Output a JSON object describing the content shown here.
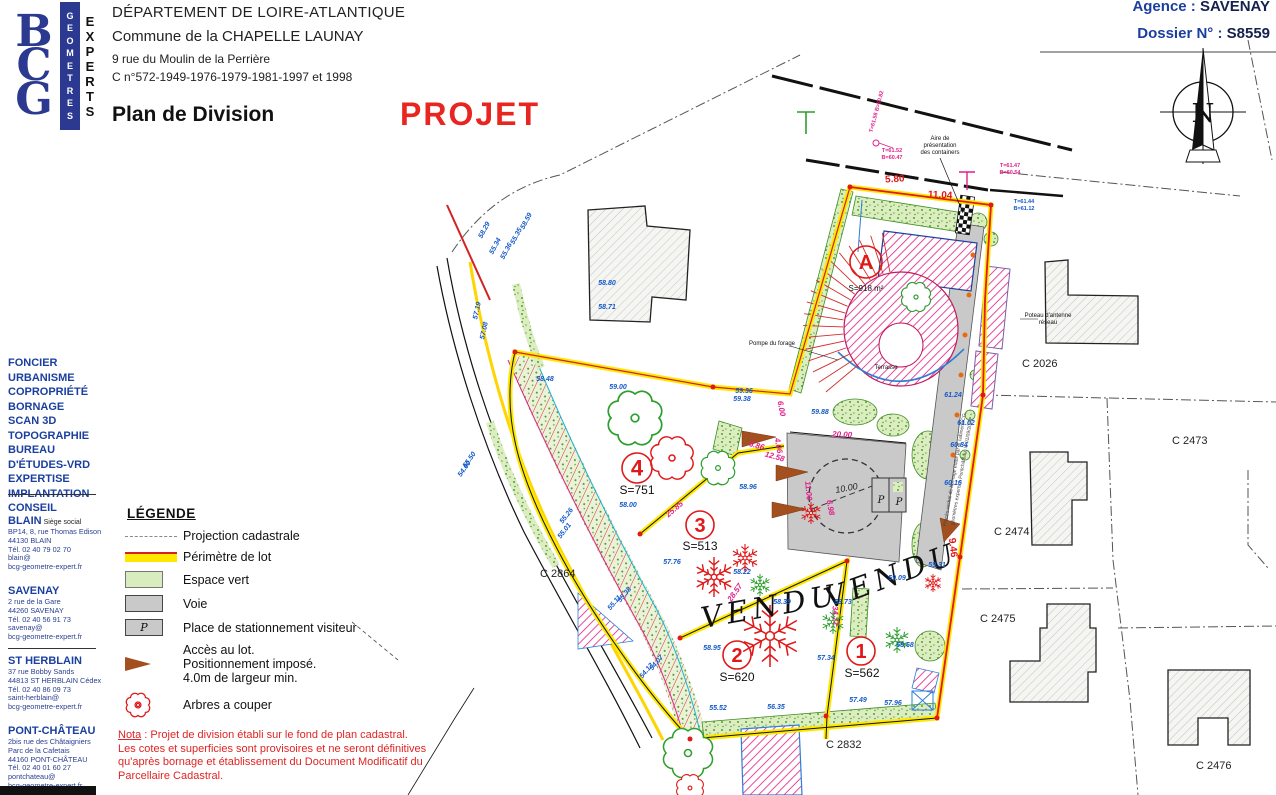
{
  "header": {
    "line1": "DÉPARTEMENT DE LOIRE-ATLANTIQUE",
    "line2": "Commune de la CHAPELLE LAUNAY",
    "line3": "9 rue du Moulin de la Perrière",
    "line4": "C n°572-1949-1976-1979-1981-1997 et 1998",
    "title": "Plan de Division",
    "stamp": "PROJET",
    "agency_label": "Agence",
    "agency_value": "SAVENAY",
    "dossier_label": "Dossier N°",
    "dossier_value": "S8559"
  },
  "logo": {
    "letters": [
      "B",
      "C",
      "G"
    ],
    "col1": "GEOMETRES",
    "col2": "EXPERTS"
  },
  "sidebar": {
    "services": [
      "FONCIER",
      "URBANISME",
      "COPROPRIÉTÉ",
      "BORNAGE",
      "SCAN 3D",
      "TOPOGRAPHIE",
      "BUREAU",
      "D'ÉTUDES-VRD",
      "EXPERTISE",
      "IMPLANTATION",
      "CONSEIL"
    ],
    "offices": [
      {
        "name": "BLAIN",
        "sub": "Siège social",
        "lines": [
          "BP14, 8, rue Thomas Edison",
          "44130 BLAIN",
          "Tél. 02 40 79 02 70",
          "blain@",
          "bcg-geometre-expert.fr"
        ]
      },
      {
        "name": "SAVENAY",
        "sub": "",
        "lines": [
          "2 rue de la Gare",
          "44260 SAVENAY",
          "Tél. 02 40 56 91 73",
          "savenay@",
          "bcg-geometre-expert.fr"
        ]
      },
      {
        "name": "ST HERBLAIN",
        "sub": "",
        "lines": [
          "37 rue Bobby Sands",
          "44813 ST HERBLAIN Cédex",
          "Tél. 02 40 86 09 73",
          "saint-herblain@",
          "bcg-geometre-expert.fr"
        ]
      },
      {
        "name": "PONT-CHÂTEAU",
        "sub": "",
        "lines": [
          "2bis rue des Châtaigniers",
          "Parc de la Cafetais",
          "44160 PONT-CHÂTEAU",
          "Tél. 02 40 01 60 27",
          "pontchateau@",
          "bcg-geometre-expert.fr"
        ]
      }
    ]
  },
  "legend": {
    "title": "LÉGENDE",
    "items": [
      {
        "sw": "cadastral",
        "lines": [
          "Projection cadastrale"
        ]
      },
      {
        "sw": "perimetre",
        "lines": [
          "Périmètre de lot"
        ]
      },
      {
        "sw": "vert",
        "lines": [
          "Espace vert"
        ]
      },
      {
        "sw": "voie",
        "lines": [
          "Voie"
        ]
      },
      {
        "sw": "parking",
        "p": "P",
        "lines": [
          "Place de stationnement visiteur"
        ]
      },
      {
        "sw": "acces",
        "lines": [
          "Accès au lot.",
          "Positionnement imposé.",
          "4.0m de largeur min."
        ]
      },
      {
        "sw": "arbre",
        "lines": [
          "Arbres a couper"
        ]
      }
    ]
  },
  "nota": {
    "label": "Nota",
    "line1rest": " : Projet de division établi sur le fond de plan cadastral.",
    "lines": [
      "Les cotes et superficies sont provisoires et ne seront définitives",
      "qu'après bornage et établissement du Document Modificatif du",
      "Parcellaire Cadastral."
    ]
  },
  "map": {
    "lots": [
      {
        "id": "A",
        "cx": 866,
        "cy": 262,
        "r": 16,
        "ns": 20,
        "area": "S=918 m²",
        "ax": 866,
        "ay": 291,
        "as": 8
      },
      {
        "id": "4",
        "cx": 637,
        "cy": 468,
        "r": 15,
        "ns": 22,
        "area": "S=751",
        "ax": 637,
        "ay": 494,
        "as": 12
      },
      {
        "id": "3",
        "cx": 700,
        "cy": 525,
        "r": 14,
        "ns": 20,
        "area": "S=513",
        "ax": 700,
        "ay": 550,
        "as": 12
      },
      {
        "id": "2",
        "cx": 737,
        "cy": 655,
        "r": 14,
        "ns": 20,
        "area": "S=620",
        "ax": 737,
        "ay": 681,
        "as": 12
      },
      {
        "id": "1",
        "cx": 861,
        "cy": 651,
        "r": 14,
        "ns": 20,
        "area": "S=562",
        "ax": 862,
        "ay": 677,
        "as": 12
      }
    ],
    "labels": [
      {
        "t": "C 2026",
        "x": 1022,
        "y": 367,
        "c": "parcel",
        "a": "start"
      },
      {
        "t": "C 2473",
        "x": 1172,
        "y": 444,
        "c": "parcel",
        "a": "start"
      },
      {
        "t": "C 2474",
        "x": 994,
        "y": 535,
        "c": "parcel",
        "a": "start"
      },
      {
        "t": "C 2475",
        "x": 980,
        "y": 622,
        "c": "parcel",
        "a": "start"
      },
      {
        "t": "C 2832",
        "x": 826,
        "y": 748,
        "c": "parcel",
        "a": "start"
      },
      {
        "t": "C 2864",
        "x": 540,
        "y": 577,
        "c": "parcel",
        "a": "start"
      },
      {
        "t": "C 2476",
        "x": 1196,
        "y": 769,
        "c": "parcel",
        "a": "start"
      },
      {
        "t": "VENDU",
        "x": 772,
        "y": 616,
        "c": "vendu",
        "r": -10
      },
      {
        "t": "VENDU",
        "x": 895,
        "y": 585,
        "c": "vendu",
        "r": -20
      },
      {
        "t": "Aire de",
        "x": 940,
        "y": 140,
        "c": "tiny"
      },
      {
        "t": "présentation",
        "x": 940,
        "y": 147,
        "c": "tiny"
      },
      {
        "t": "des containers",
        "x": 940,
        "y": 154,
        "c": "tiny"
      },
      {
        "t": "Pompe du forage",
        "x": 772,
        "y": 345,
        "c": "tiny"
      },
      {
        "t": "Terrasse",
        "x": 886,
        "y": 369,
        "c": "tiny"
      },
      {
        "t": "Poteau d'antenne",
        "x": 1048,
        "y": 317,
        "c": "tiny"
      },
      {
        "t": "réseau",
        "x": 1048,
        "y": 324,
        "c": "tiny"
      },
      {
        "t": "5.80",
        "x": 895,
        "y": 182,
        "c": "dimr",
        "r": -4
      },
      {
        "t": "11.04",
        "x": 940,
        "y": 198,
        "c": "dimr",
        "r": 3
      },
      {
        "t": "9.46",
        "x": 950,
        "y": 548,
        "c": "dimr",
        "r": 83
      },
      {
        "t": "20.00",
        "x": 842,
        "y": 437,
        "c": "dimm",
        "r": 3
      },
      {
        "t": "10.00",
        "x": 847,
        "y": 491,
        "c": "dimk",
        "r": -10
      },
      {
        "t": "6.00",
        "x": 779,
        "y": 409,
        "c": "dimm",
        "r": 80
      },
      {
        "t": "4.06",
        "x": 776,
        "y": 446,
        "c": "dimm",
        "r": 80
      },
      {
        "t": "6.86",
        "x": 756,
        "y": 448,
        "c": "dimm",
        "r": 15
      },
      {
        "t": "12.58",
        "x": 774,
        "y": 459,
        "c": "dimm",
        "r": 15
      },
      {
        "t": "25.85",
        "x": 676,
        "y": 511,
        "c": "dimm",
        "r": -40
      },
      {
        "t": "11.00",
        "x": 806,
        "y": 491,
        "c": "dimm",
        "r": 85
      },
      {
        "t": "6.98",
        "x": 828,
        "y": 508,
        "c": "dimm",
        "r": 80
      },
      {
        "t": "28.57",
        "x": 737,
        "y": 594,
        "c": "dimm",
        "r": -55
      },
      {
        "t": "34.72",
        "x": 833,
        "y": 616,
        "c": "dimm",
        "r": 87
      },
      {
        "t": "T=61.52",
        "x": 892,
        "y": 152,
        "c": "notem"
      },
      {
        "t": "B=60.47",
        "x": 892,
        "y": 159,
        "c": "notem"
      },
      {
        "t": "T=61.58 B=60.82",
        "x": 878,
        "y": 112,
        "c": "notem",
        "r": -75
      },
      {
        "t": "T=61.47",
        "x": 1010,
        "y": 167,
        "c": "notem"
      },
      {
        "t": "B=60.54",
        "x": 1010,
        "y": 174,
        "c": "notem"
      },
      {
        "t": "T=61.44",
        "x": 1024,
        "y": 203,
        "c": "noteb"
      },
      {
        "t": "B=61.12",
        "x": 1024,
        "y": 210,
        "c": "noteb"
      },
      {
        "t": "Procès-verbal de bornage établi par le cabinet BCG",
        "x": 956,
        "y": 470,
        "c": "rot",
        "r": -80
      },
      {
        "t": "géomètres experts à Pontchâteau, le 01/09/2021",
        "x": 963,
        "y": 472,
        "c": "rot",
        "r": -80
      },
      {
        "t": "58.48",
        "x": 545,
        "y": 381,
        "c": "elev"
      },
      {
        "t": "59.00",
        "x": 618,
        "y": 389,
        "c": "elev"
      },
      {
        "t": "59.36",
        "x": 744,
        "y": 393,
        "c": "elev"
      },
      {
        "t": "59.38",
        "x": 742,
        "y": 401,
        "c": "elev"
      },
      {
        "t": "59.88",
        "x": 820,
        "y": 414,
        "c": "elev"
      },
      {
        "t": "58.96",
        "x": 748,
        "y": 489,
        "c": "elev"
      },
      {
        "t": "58.00",
        "x": 628,
        "y": 507,
        "c": "elev"
      },
      {
        "t": "57.76",
        "x": 672,
        "y": 564,
        "c": "elev"
      },
      {
        "t": "58.22",
        "x": 742,
        "y": 574,
        "c": "elev"
      },
      {
        "t": "58.39",
        "x": 782,
        "y": 604,
        "c": "elev"
      },
      {
        "t": "58.73",
        "x": 843,
        "y": 604,
        "c": "elev"
      },
      {
        "t": "59.31",
        "x": 937,
        "y": 567,
        "c": "elev"
      },
      {
        "t": "59.09",
        "x": 897,
        "y": 580,
        "c": "elev"
      },
      {
        "t": "58.95",
        "x": 712,
        "y": 650,
        "c": "elev"
      },
      {
        "t": "57.34",
        "x": 826,
        "y": 660,
        "c": "elev"
      },
      {
        "t": "58.68",
        "x": 905,
        "y": 647,
        "c": "elev"
      },
      {
        "t": "57.49",
        "x": 858,
        "y": 702,
        "c": "elev"
      },
      {
        "t": "57.96",
        "x": 893,
        "y": 705,
        "c": "elev"
      },
      {
        "t": "55.52",
        "x": 718,
        "y": 710,
        "c": "elev"
      },
      {
        "t": "56.35",
        "x": 776,
        "y": 709,
        "c": "elev"
      },
      {
        "t": "61.24",
        "x": 953,
        "y": 397,
        "c": "elev"
      },
      {
        "t": "61.02",
        "x": 966,
        "y": 425,
        "c": "elev"
      },
      {
        "t": "60.84",
        "x": 959,
        "y": 447,
        "c": "elev"
      },
      {
        "t": "60.16",
        "x": 953,
        "y": 485,
        "c": "elev"
      },
      {
        "t": "58.80",
        "x": 607,
        "y": 285,
        "c": "elev"
      },
      {
        "t": "58.71",
        "x": 607,
        "y": 309,
        "c": "elev"
      },
      {
        "t": "54.07",
        "x": 658,
        "y": 664,
        "c": "elev",
        "r": -50
      },
      {
        "t": "54.13",
        "x": 648,
        "y": 672,
        "c": "elev",
        "r": -50
      },
      {
        "t": "55.26",
        "x": 568,
        "y": 517,
        "c": "elev",
        "r": -52
      },
      {
        "t": "55.01",
        "x": 566,
        "y": 532,
        "c": "elev",
        "r": -52
      },
      {
        "t": "55.38",
        "x": 626,
        "y": 596,
        "c": "elev",
        "r": -50
      },
      {
        "t": "55.11",
        "x": 616,
        "y": 604,
        "c": "elev",
        "r": -50
      },
      {
        "t": "55.50",
        "x": 471,
        "y": 461,
        "c": "elev",
        "r": -55
      },
      {
        "t": "54.60",
        "x": 466,
        "y": 470,
        "c": "elev",
        "r": -55
      },
      {
        "t": "55.34",
        "x": 497,
        "y": 247,
        "c": "elev",
        "r": -62
      },
      {
        "t": "55.36",
        "x": 508,
        "y": 252,
        "c": "elev",
        "r": -62
      },
      {
        "t": "55.35",
        "x": 518,
        "y": 237,
        "c": "elev",
        "r": -62
      },
      {
        "t": "58.59",
        "x": 528,
        "y": 222,
        "c": "elev",
        "r": -62
      },
      {
        "t": "58.29",
        "x": 486,
        "y": 231,
        "c": "elev",
        "r": -62
      },
      {
        "t": "57.19",
        "x": 479,
        "y": 311,
        "c": "elev",
        "r": -78
      },
      {
        "t": "57.08",
        "x": 486,
        "y": 331,
        "c": "elev",
        "r": -78
      },
      {
        "t": "P",
        "x": 881,
        "y": 503,
        "c": "pk"
      },
      {
        "t": "P",
        "x": 899,
        "y": 505,
        "c": "pk"
      },
      {
        "t": "N",
        "x": 1203,
        "y": 122,
        "c": "north"
      }
    ]
  },
  "colors": {
    "brand_blue": "#2b3990",
    "stamp_red": "#e8251f",
    "lot_red": "#e01818",
    "elev_blue": "#1459c8",
    "magenta": "#e0218a",
    "perimeter_yellow": "#ffe800",
    "green": "#55a02e",
    "road_gray": "#c9c9c9",
    "access_brown": "#a34f1f"
  }
}
